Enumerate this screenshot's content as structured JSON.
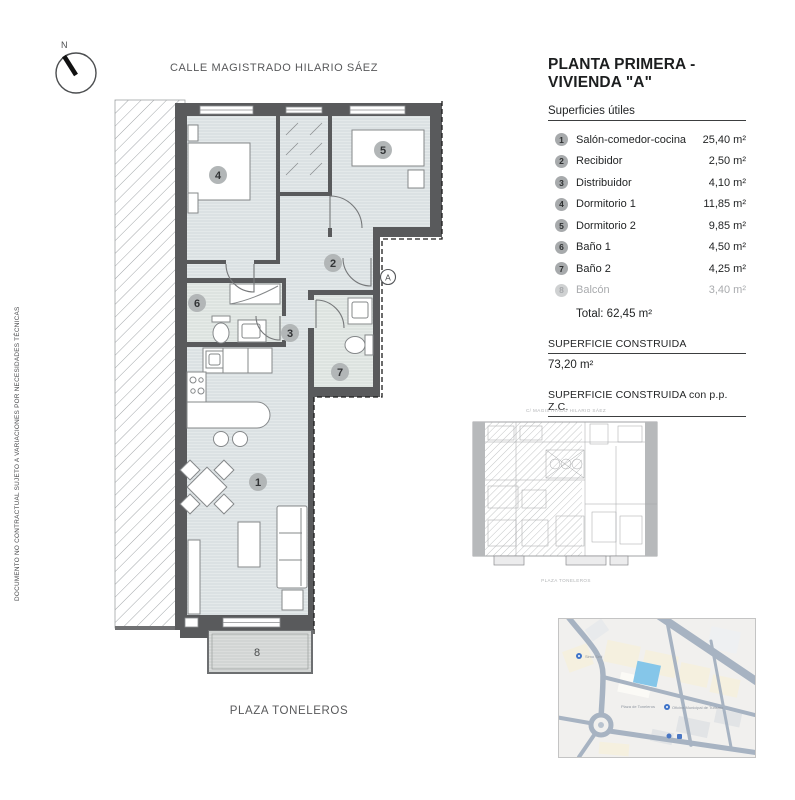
{
  "colors": {
    "wall": "#595a5c",
    "room_fill": "#dbe1e3",
    "bath_fill": "#dee4e1",
    "balcony_fill": "#d2d5d4",
    "badge": "#b2b6b7",
    "muted": "#a9abae",
    "map_road": "#a7b3c2",
    "map_parcel": "#85c6e9"
  },
  "compass": {
    "label": "N"
  },
  "streets": {
    "top": "CALLE MAGISTRADO HILARIO SÁEZ",
    "bottom": "PLAZA TONELEROS"
  },
  "side_note": "DOCUMENTO NO CONTRACTUAL SUJETO A VARIACIONES POR NECESIDADES TÉCNICAS",
  "legend": {
    "title": "PLANTA PRIMERA - VIVIENDA \"A\"",
    "subtitle": "Superficies útiles",
    "rows": [
      {
        "num": "1",
        "label": "Salón-comedor-cocina",
        "value": "25,40 m²"
      },
      {
        "num": "2",
        "label": "Recibidor",
        "value": "2,50 m²"
      },
      {
        "num": "3",
        "label": "Distribuidor",
        "value": "4,10 m²"
      },
      {
        "num": "4",
        "label": "Dormitorio 1",
        "value": "11,85 m²"
      },
      {
        "num": "5",
        "label": "Dormitorio 2",
        "value": "9,85 m²"
      },
      {
        "num": "6",
        "label": "Baño 1",
        "value": "4,50 m²"
      },
      {
        "num": "7",
        "label": "Baño 2",
        "value": "4,25 m²"
      },
      {
        "num": "8",
        "label": "Balcón",
        "value": "3,40 m²"
      }
    ],
    "total": "Total: 62,45 m²",
    "built": {
      "header": "SUPERFICIE CONSTRUIDA",
      "value": "73,20 m²"
    },
    "built_zc": {
      "header": "SUPERFICIE CONSTRUIDA  con p.p. Z.C.",
      "value": "84,31 m²"
    }
  },
  "plan": {
    "rooms": [
      {
        "num": "1"
      },
      {
        "num": "2"
      },
      {
        "num": "3"
      },
      {
        "num": "4"
      },
      {
        "num": "5"
      },
      {
        "num": "6"
      },
      {
        "num": "7"
      },
      {
        "num": "8"
      }
    ],
    "section_mark": "A"
  },
  "thumbnail": {
    "caption_top": "C/ MAGISTRADO HILARIO SÁEZ",
    "caption_bottom": "PLAZA TONELEROS"
  },
  "map": {
    "labels": [
      "Plaza de Toneleros",
      "Oficina Municipal de Turismo",
      "Simo Sed"
    ]
  }
}
